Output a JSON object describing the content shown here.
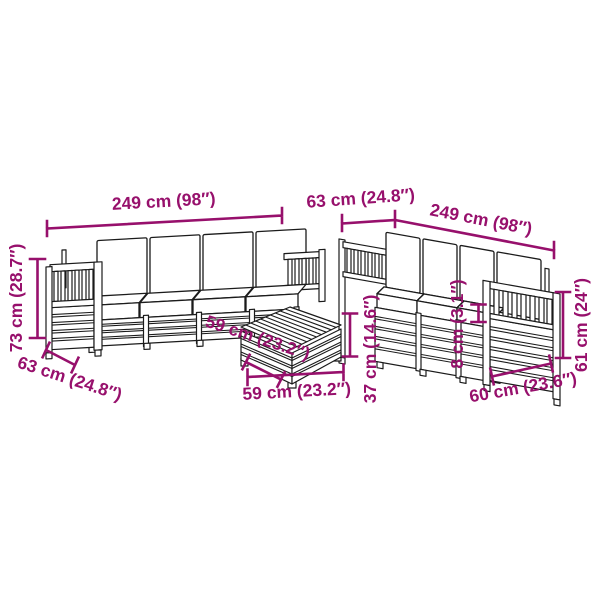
{
  "diagram": {
    "accent_color": "#97106C",
    "line_color": "#1B1B1B",
    "background_color": "#FFFFFF",
    "dimensions": {
      "left_sofa_width": "249 cm (98″)",
      "left_sofa_height": "73 cm (28.7″)",
      "left_sofa_depth": "63 cm (24.8″)",
      "right_sofa_depth": "63 cm (24.8″)",
      "right_sofa_width": "249 cm (98″)",
      "table_depth": "59 cm (23.2″)",
      "table_width": "59 cm (23.2″)",
      "table_height": "37 cm (14.6″)",
      "seat_cushion_thickness": "8 cm (3.1″)",
      "right_sofa_height": "61 cm (24″)",
      "armrest_section_width": "60 cm (23.6″)"
    }
  }
}
